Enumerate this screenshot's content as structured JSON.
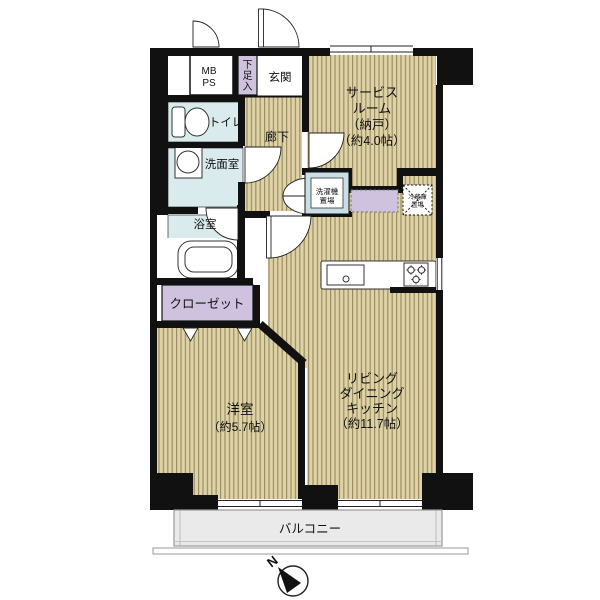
{
  "rooms": {
    "mbps": {
      "lines": [
        "MB",
        "PS"
      ]
    },
    "shoe": {
      "chars": [
        "下",
        "足",
        "入"
      ]
    },
    "genkan": {
      "label": "玄関"
    },
    "service": {
      "lines": [
        "サービス",
        "ルーム",
        "（納戸）",
        "（約4.0帖）"
      ]
    },
    "toilet": {
      "label": "トイレ"
    },
    "corridor": {
      "label": "廊下"
    },
    "washroom": {
      "label": "洗面室"
    },
    "bath": {
      "label": "浴室"
    },
    "washer": {
      "lines": [
        "洗濯機",
        "置場"
      ]
    },
    "fridge": {
      "lines": [
        "冷蔵庫",
        "置場"
      ]
    },
    "closet": {
      "label": "クローゼット"
    },
    "western": {
      "lines": [
        "洋室",
        "（約5.7帖）"
      ]
    },
    "ldk": {
      "lines": [
        "リビング",
        "ダイニング",
        "キッチン",
        "（約11.7帖）"
      ]
    },
    "balcony": {
      "label": "バルコニー"
    }
  },
  "compass": {
    "label": "N"
  },
  "colors": {
    "wall": "#111111",
    "floor_base": "#ded2a6",
    "floor_stripe": "#9a8e63",
    "wet_room_blue": "#d9ebec",
    "storage_purple": "#cfc2de",
    "balcony_gray": "#eaeaea",
    "washer_frame_blue": "#c9dfe5"
  }
}
